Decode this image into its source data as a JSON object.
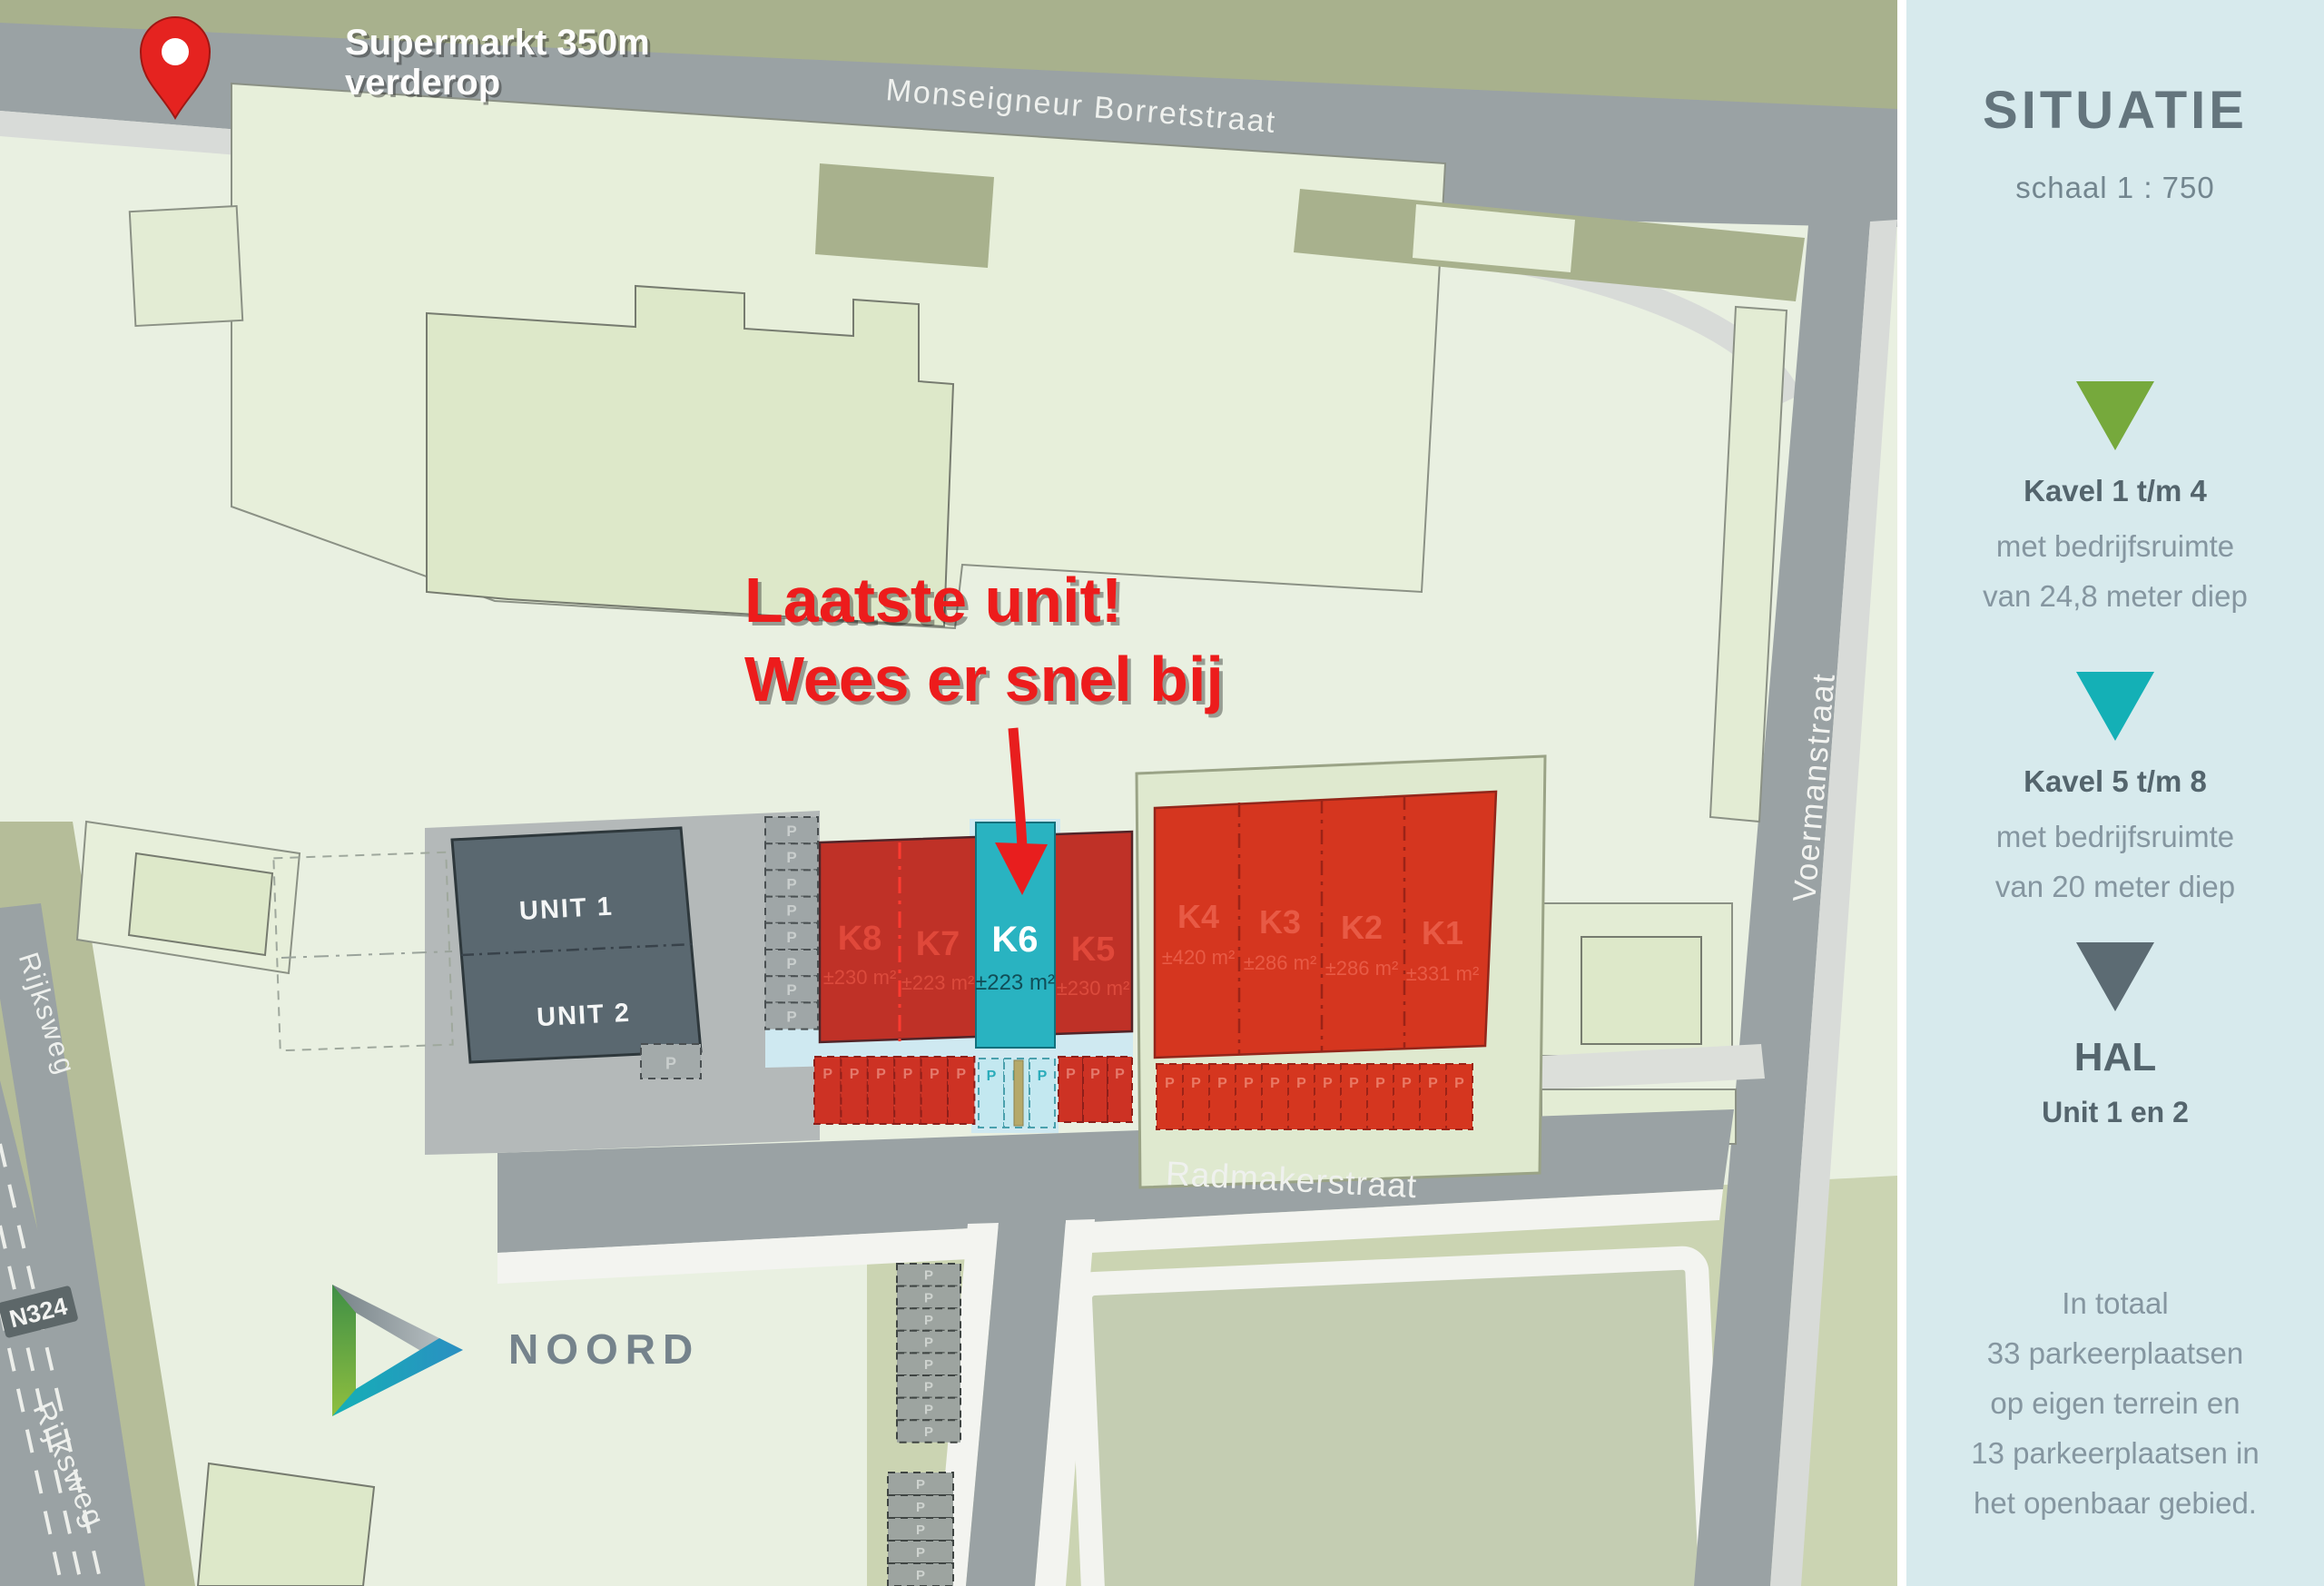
{
  "sidebar": {
    "title": "SITUATIE",
    "subtitle": "schaal 1 : 750",
    "legend": [
      {
        "title": "Kavel 1 t/m 4",
        "line1": "met bedrijfsruimte",
        "line2": "van 24,8 meter diep",
        "color": "#76a93c"
      },
      {
        "title": "Kavel 5 t/m 8",
        "line1": "met bedrijfsruimte",
        "line2": "van 20 meter diep",
        "color": "#14b0b6"
      },
      {
        "title": "HAL",
        "line1": "Unit 1 en 2",
        "line2": "",
        "color": "#5c6b73"
      }
    ],
    "footer": [
      "In totaal",
      "33 parkeerplaatsen",
      "op eigen terrein en",
      "13 parkeerplaatsen in",
      "het openbaar gebied."
    ]
  },
  "map": {
    "pin": {
      "line1": "Supermarkt 350m",
      "line2": "verderop"
    },
    "annotation": {
      "line1": "Laatste unit!",
      "line2": "Wees er snel bij"
    },
    "streets": {
      "top": "Monseigneur Borretstraat",
      "south": "Radmakerstraat",
      "east": "Voermanstraat",
      "west_upper": "Rijksweg",
      "west_lower": "Rijksweg",
      "route_badge": "N324"
    },
    "logo": "NOORD",
    "units": {
      "unit1": "UNIT 1",
      "unit2": "UNIT 2"
    },
    "kavels": [
      {
        "label": "K8",
        "area": "±230 m²"
      },
      {
        "label": "K7",
        "area": "±223 m²"
      },
      {
        "label": "K6",
        "area": "±223 m²"
      },
      {
        "label": "K5",
        "area": "±230 m²"
      },
      {
        "label": "K4",
        "area": "±420 m²"
      },
      {
        "label": "K3",
        "area": "±286 m²"
      },
      {
        "label": "K2",
        "area": "±286 m²"
      },
      {
        "label": "K1",
        "area": "±331 m²"
      }
    ],
    "parking_letter": "P",
    "colors": {
      "highlight_teal": "#29b3c1",
      "kavel_red": "#bf3127",
      "kavel_red_bright": "#d5361f",
      "hal_dark": "#5a6870",
      "annotation_red": "#ed1c1c",
      "pin_red": "#e52320"
    }
  }
}
